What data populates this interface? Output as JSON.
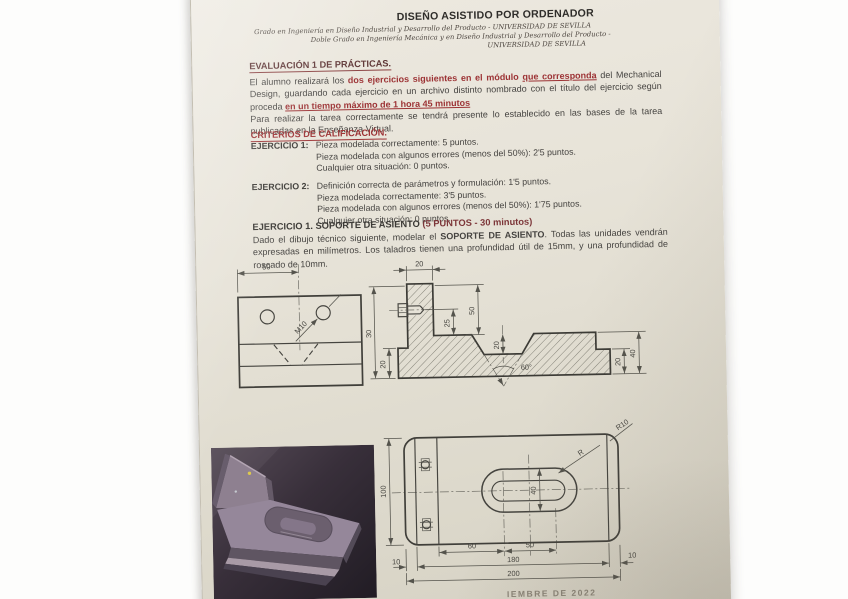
{
  "document": {
    "header": {
      "title": "DISEÑO ASISTIDO POR ORDENADOR",
      "subtitle_line1": "Grado en Ingeniería en Diseño Industrial y Desarrollo del Producto - UNIVERSIDAD DE SEVILLA",
      "subtitle_line2": "Doble Grado en Ingeniería Mecánica y en Diseño Industrial y Desarrollo del Producto -",
      "subtitle_line3": "UNIVERSIDAD DE SEVILLA"
    },
    "evaluation": {
      "heading": "EVALUACIÓN 1 DE PRÁCTICAS.",
      "intro": {
        "black1": "El alumno realizará los ",
        "red1": "dos ejercicios siguientes en el módulo ",
        "red_underlined1": "que corresponda",
        "black2": " del Mechanical Design, guardando cada ejercicio en un archivo distinto nombrado con el título del ejercicio según proceda ",
        "red_underlined2": "en un tiempo máximo de 1 hora 45 minutos",
        "black3": "Para realizar la tarea correctamente se tendrá presente lo establecido en las bases de la tarea publicadas en la Enseñanza Virtual."
      }
    },
    "criteria": {
      "heading": "CRITERIOS DE CALIFICACIÓN.",
      "exercise1_label": "EJERCICIO 1:",
      "exercise1_lines": [
        "Pieza modelada correctamente: 5 puntos.",
        "Pieza modelada con algunos errores (menos del 50%): 2'5 puntos.",
        "Cualquier otra situación: 0 puntos."
      ],
      "exercise2_label": "EJERCICIO 2:",
      "exercise2_lines": [
        "Definición correcta de parámetros y formulación: 1'5 puntos.",
        "Pieza modelada correctamente: 3'5 puntos.",
        "Pieza modelada con algunos errores (menos del 50%): 1'75 puntos.",
        "Cualquier otra situación: 0 puntos."
      ]
    },
    "exercise1": {
      "title_main": "EJERCICIO 1. SOPORTE DE ASIENTO ",
      "title_detail": "(5 PUNTOS - 30 minutos)",
      "body_part1": "Dado el dibujo técnico siguiente, modelar el ",
      "body_bold": "SOPORTE DE ASIENTO",
      "body_part2": ". Todas las unidades vendrán expresadas en milímetros. Los taladros tienen una profundidad útil de 15mm, y una profundidad de roscado de 10mm."
    },
    "footer_partial": "IEMBRE DE 2022"
  },
  "drawings": {
    "front_view": {
      "dim_width_half": "50",
      "thread_label": "M10"
    },
    "section_view": {
      "dim_wall_thickness": "20",
      "dim_left_outer": "30",
      "dim_left_inner": "20",
      "dim_wall_height": "50",
      "dim_thread_height": "25",
      "dim_groove_depth": "20",
      "groove_angle": "60°",
      "dim_base_height": "40",
      "dim_step_height": "20"
    },
    "plan_view": {
      "dim_width": "100",
      "corner_radius": "R10",
      "slot_radius": "R",
      "dim_slot_width": "40",
      "dim_slot_offset": "60",
      "dim_slot_length": "50",
      "dim_end_left": "10",
      "dim_inner_length": "180",
      "dim_end_right": "10",
      "dim_total_length": "200"
    }
  },
  "colors": {
    "accent_red": "#9c3234",
    "paper": "#e6e2d7",
    "ink": "#454340",
    "drawing_line": "#45443f"
  }
}
